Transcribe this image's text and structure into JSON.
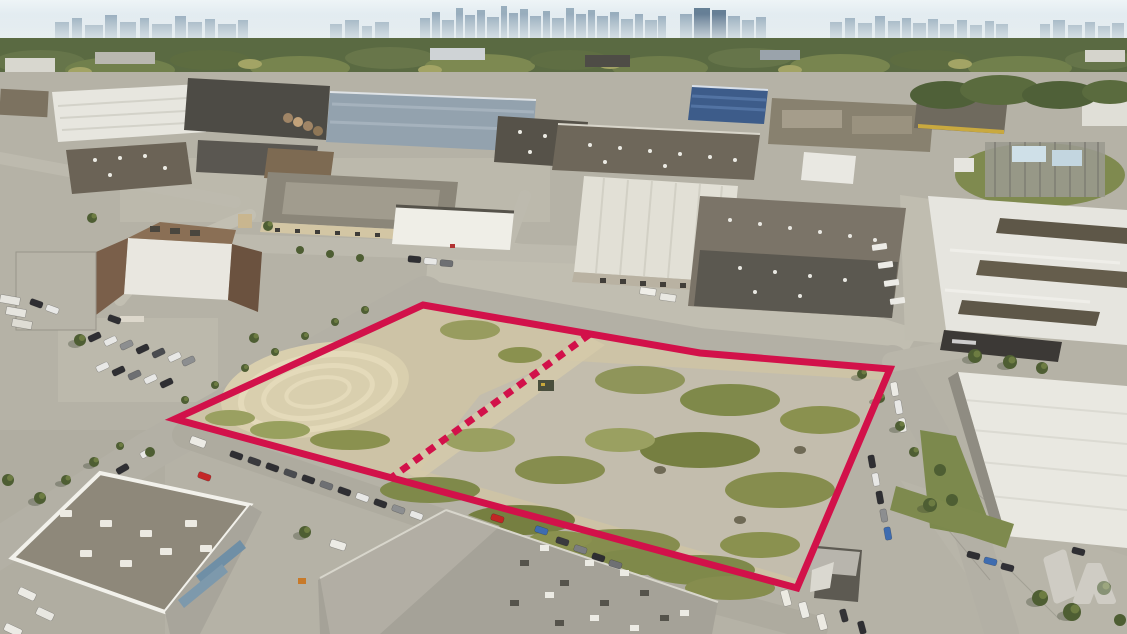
{
  "image": {
    "kind": "aerial-drone-photograph",
    "subject": "vacant industrial development land parcel outlined in red within a light-industrial district, hazy city skyline on the horizon",
    "width_px": 1127,
    "height_px": 634
  },
  "parcel": {
    "boundary_color": "#d2114a",
    "boundary_stroke_width": 7,
    "boundary_points": "423,305 700,353 890,369 797,588 175,419",
    "divider": {
      "x1": 590,
      "y1": 334,
      "x2": 391,
      "y2": 478,
      "dasharray": "9 7",
      "stroke_width": 7
    },
    "fill": "#cdc3a6"
  },
  "watermark": {
    "color": "#ffffff",
    "opacity": 0.32
  },
  "palette": {
    "sky": "#e9f1f5",
    "sky_low": "#ccdbe4",
    "skyline": "#8ba2b4",
    "treeline": "#5a6a42",
    "ground": "#b5b2a6",
    "road": "#b3b0a5",
    "concrete": "#c4c1b4",
    "scrub_green": "#8a914f",
    "roof_white": "#e8e7e1",
    "roof_dark": "#55524a",
    "roof_brown": "#6e675a",
    "roof_blue": "#3d5c8a"
  }
}
